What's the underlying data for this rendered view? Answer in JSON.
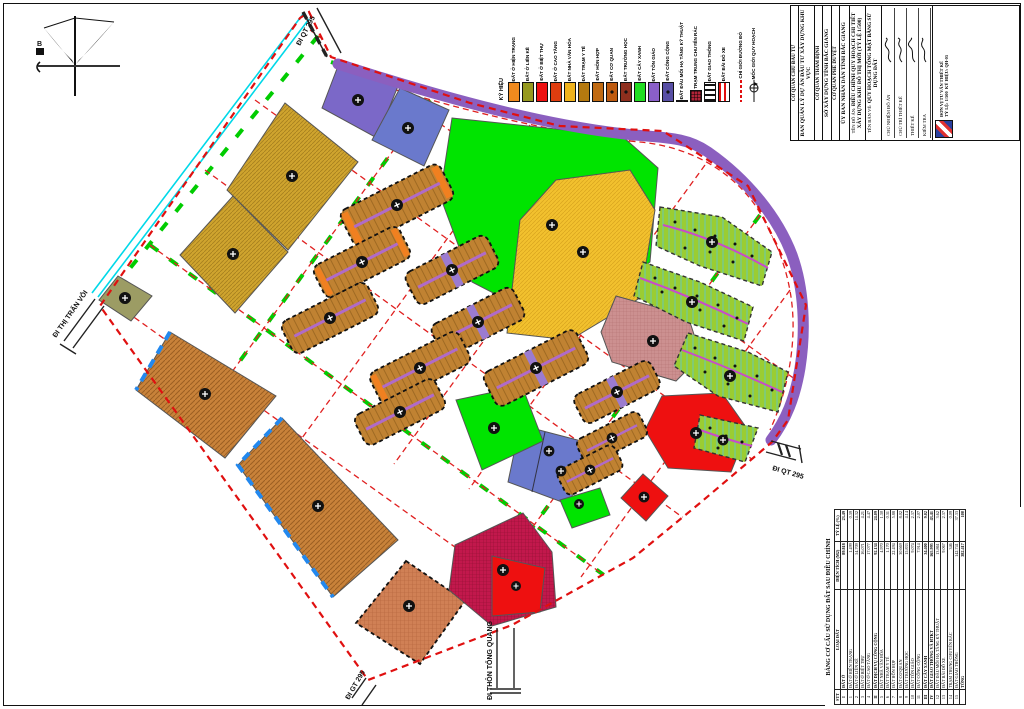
{
  "sheet": {
    "type": "land-use planning drawing",
    "north_label": "B"
  },
  "legend": {
    "title": "KÝ HIỆU",
    "items": [
      {
        "label": "ĐẤT Ở HIỆN TRẠNG",
        "color": "#F08A1E",
        "pattern": "solid"
      },
      {
        "label": "ĐẤT Ở LIỀN KỀ",
        "color": "#96991F",
        "pattern": "solid"
      },
      {
        "label": "ĐẤT Ở BIỆT THỰ",
        "color": "#EE1111",
        "pattern": "solid"
      },
      {
        "label": "ĐẤT Ở CAO TẦNG",
        "color": "#DF3D0F",
        "pattern": "solid"
      },
      {
        "label": "ĐẤT NHÀ VĂN HÓA",
        "color": "#F0B31D",
        "pattern": "solid"
      },
      {
        "label": "ĐẤT TRẠM Y TẾ",
        "color": "#B5790F",
        "pattern": "solid"
      },
      {
        "label": "ĐẤT HỖN HỢP",
        "color": "#C06A12",
        "pattern": "solid"
      },
      {
        "label": "ĐẤT CƠ QUAN",
        "color": "#BE5B10",
        "pattern": "dot"
      },
      {
        "label": "ĐẤT TRƯỜNG HỌC",
        "color": "#8E2F1E",
        "pattern": "dot"
      },
      {
        "label": "ĐẤT CÂY XANH",
        "color": "#22DD22",
        "pattern": "solid"
      },
      {
        "label": "ĐẤT TÔN GIÁO",
        "color": "#8A5FC8",
        "pattern": "solid"
      },
      {
        "label": "ĐẤT CÔNG CỘNG",
        "color": "#584FA5",
        "pattern": "dot"
      },
      {
        "label": "ĐẤT ĐẦU MỐI HẠ TẦNG KỸ THUẬT",
        "color": "#9A9A62",
        "pattern": "solid"
      },
      {
        "label": "TRẠM TRUNG CHUYỂN RÁC",
        "color": "#B02438",
        "pattern": "grid"
      },
      {
        "label": "ĐẤT GIAO THÔNG",
        "color": "#FFFFFF",
        "pattern": "stripes"
      },
      {
        "label": "ĐẤT BÃI ĐỖ XE",
        "color": "#FFFFFF",
        "pattern": "hbar"
      }
    ],
    "line_items": [
      {
        "label": "CHỈ GIỚI ĐƯỜNG ĐỎ"
      },
      {
        "label": "MỐC GIỚI QUY HOẠCH"
      }
    ]
  },
  "title_block": {
    "cols": [
      {
        "header": "CƠ QUAN CHỦ ĐẦU TƯ",
        "body": "BAN QUẢN LÝ DỰ ÁN ĐẦU TƯ XÂY DỰNG KHU VỰC"
      },
      {
        "header": "CƠ QUAN THẨM ĐỊNH",
        "body": "SỞ XÂY DỰNG TỈNH BẮC GIANG"
      },
      {
        "header": "CƠ QUAN PHÊ DUYỆT",
        "body": "ỦY BAN NHÂN DÂN TỈNH BẮC GIANG"
      }
    ],
    "project_label": "TÊN ĐỒ ÁN:",
    "project": "ĐIỀU CHỈNH QUY HOẠCH CHI TIẾT XÂY DỰNG KHU ĐÔ THỊ MỚI (TỶ LỆ 1/500)",
    "drawing_label": "TÊN BẢN VẼ:",
    "drawing": "QUY HOẠCH TỔNG MẶT BẰNG SỬ DỤNG ĐẤT",
    "signatures": [
      "CHỦ NHIỆM ĐỒ ÁN",
      "CHỦ TRÌ THIẾT KẾ",
      "THIẾT KẾ",
      "KIỂM TRA"
    ],
    "company": "ĐƠN VỊ TƯ VẤN THIẾT KẾ",
    "scale_label": "TỶ LỆ:",
    "scale": "1/500",
    "drawing_no_label": "KÝ HIỆU:",
    "drawing_no": "QH-05"
  },
  "land_use_table": {
    "title": "BẢNG CƠ CẤU SỬ DỤNG ĐẤT SAU ĐIỀU CHỈNH",
    "columns": [
      "STT",
      "LOẠI ĐẤT",
      "DIỆN TÍCH (M2)",
      "TỶ LỆ (%)"
    ],
    "rows": [
      [
        "I",
        "ĐẤT Ở",
        "89.818",
        "23.49"
      ],
      [
        "1",
        "ĐẤT Ở HIỆN TRẠNG",
        "1.499",
        "0.39"
      ],
      [
        "2",
        "ĐẤT Ở LIỀN KỀ",
        "54.709",
        "14.32"
      ],
      [
        "3",
        "ĐẤT Ở BIỆT THỰ",
        "16.071",
        "4.21"
      ],
      [
        "4",
        "ĐẤT Ở CAO TẦNG",
        "17.077",
        "4.47"
      ],
      [
        "II",
        "ĐẤT DỊCH VỤ CÔNG CỘNG",
        "92.134",
        "24.09"
      ],
      [
        "5",
        "ĐẤT NHÀ VĂN HÓA",
        "4.970",
        "1.30"
      ],
      [
        "6",
        "ĐẤT TRẠM Y TẾ",
        "1.170",
        "0.31"
      ],
      [
        "7",
        "ĐẤT HỖN HỢP",
        "22.494",
        "5.88"
      ],
      [
        "8",
        "ĐẤT CƠ QUAN",
        "30.669",
        "8.02"
      ],
      [
        "9",
        "ĐẤT TRƯỜNG HỌC",
        "15.833",
        "4.14"
      ],
      [
        "10",
        "ĐẤT TÔN GIÁO",
        "9.074",
        "2.37"
      ],
      [
        "11",
        "ĐẤT CÔNG CỘNG",
        "7.914",
        "2.07"
      ],
      [
        "III",
        "ĐẤT CÂY XANH",
        "34.400",
        "9.02"
      ],
      [
        "IV",
        "ĐẤT GIAO THÔNG VÀ HTKT",
        "165.995",
        "43.41"
      ],
      [
        "12",
        "ĐẤT ĐẦU MỐI HẠ TẦNG KỸ THUẬT",
        "13.861",
        "3.62"
      ],
      [
        "13",
        "ĐẤT BÃI ĐỖ XE",
        "9.067",
        "2.37"
      ],
      [
        "14",
        "TRẠM TRUNG CHUYỂN RÁC",
        "346",
        "0.09"
      ],
      [
        "15",
        "ĐẤT GIAO THÔNG",
        "142.741",
        "37.33"
      ],
      [
        "",
        "TỔNG",
        "382.417",
        "100"
      ]
    ]
  },
  "road_labels": [
    {
      "text": "ĐI QT 295"
    },
    {
      "text": "ĐI THỊ TRẤN VÔI"
    },
    {
      "text": "ĐI GT 295"
    },
    {
      "text": "ĐI THÔN TỔNG QUANG"
    },
    {
      "text": "ĐI QT 295"
    }
  ],
  "map": {
    "colors": {
      "boundary_red": "#E01010",
      "canal_cyan": "#00D8E8",
      "greenery": "#00E400",
      "residential_row": "#C08232",
      "villa_green": "#9ACD32",
      "high_rise_gold": "#CFA42E",
      "mixed_yellow": "#F2C12E",
      "public_red": "#EE1010",
      "school_crimson": "#C2184C",
      "office_pink": "#CC9090",
      "terracotta": "#D08055",
      "chocolate": "#C8823A",
      "violet_band": "#8B5FBF",
      "slate_blue": "#6A79CC",
      "olive": "#9C9C64",
      "road_green_strip": "#00CC00",
      "alley_magenta": "#B06BC8"
    }
  }
}
